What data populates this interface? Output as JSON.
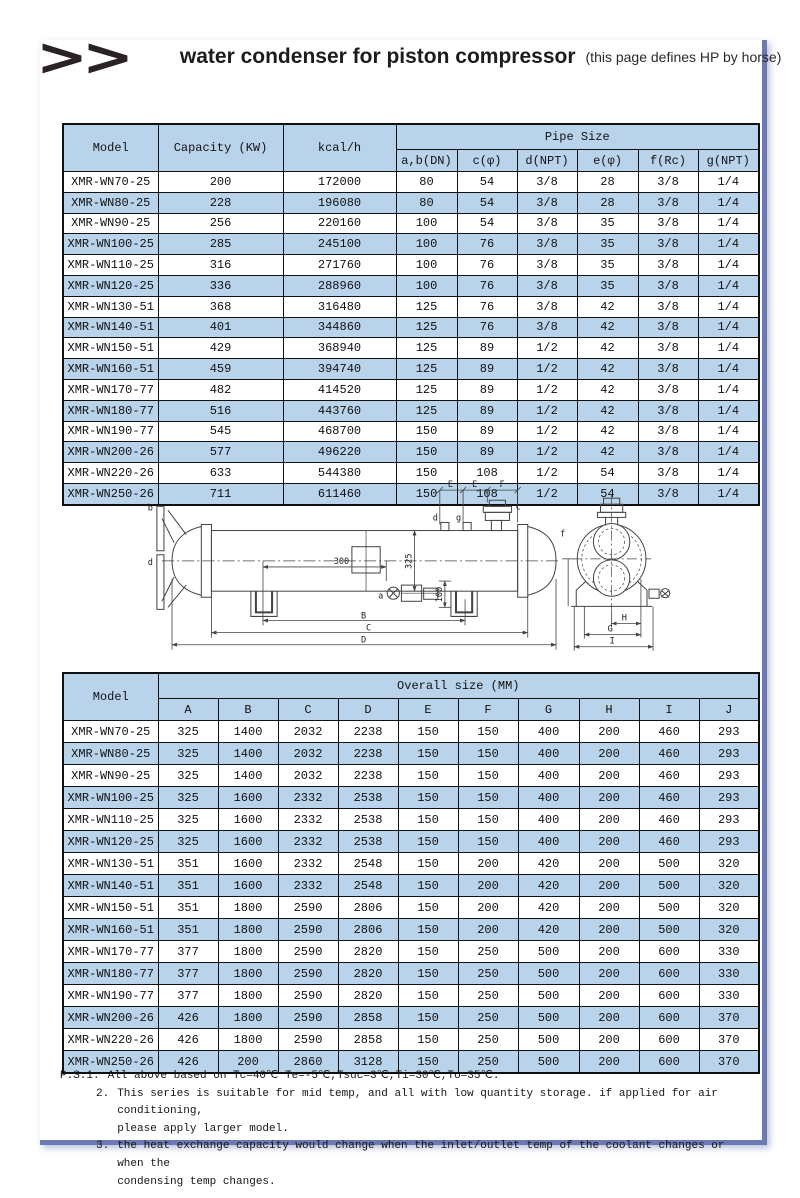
{
  "page": {
    "logo": ">>",
    "title": "water condenser for piston compressor",
    "subtitle": "(this page defines HP by horse)"
  },
  "colors": {
    "row_alt": "#b9d3ea",
    "header_bg": "#b9d3ea",
    "frame_rule": "#6b79b5",
    "table_border": "#101010"
  },
  "pipe_table": {
    "col_model": "Model",
    "col_capacity": "Capacity (KW)",
    "col_kcal": "kcal/h",
    "group_header": "Pipe Size",
    "sub_headers": [
      "a,b(DN)",
      "c(φ)",
      "d(NPT)",
      "e(φ)",
      "f(Rc)",
      "g(NPT)"
    ],
    "rows": [
      [
        "XMR-WN70-25",
        "200",
        "172000",
        "80",
        "54",
        "3/8",
        "28",
        "3/8",
        "1/4"
      ],
      [
        "XMR-WN80-25",
        "228",
        "196080",
        "80",
        "54",
        "3/8",
        "28",
        "3/8",
        "1/4"
      ],
      [
        "XMR-WN90-25",
        "256",
        "220160",
        "100",
        "54",
        "3/8",
        "35",
        "3/8",
        "1/4"
      ],
      [
        "XMR-WN100-25",
        "285",
        "245100",
        "100",
        "76",
        "3/8",
        "35",
        "3/8",
        "1/4"
      ],
      [
        "XMR-WN110-25",
        "316",
        "271760",
        "100",
        "76",
        "3/8",
        "35",
        "3/8",
        "1/4"
      ],
      [
        "XMR-WN120-25",
        "336",
        "288960",
        "100",
        "76",
        "3/8",
        "35",
        "3/8",
        "1/4"
      ],
      [
        "XMR-WN130-51",
        "368",
        "316480",
        "125",
        "76",
        "3/8",
        "42",
        "3/8",
        "1/4"
      ],
      [
        "XMR-WN140-51",
        "401",
        "344860",
        "125",
        "76",
        "3/8",
        "42",
        "3/8",
        "1/4"
      ],
      [
        "XMR-WN150-51",
        "429",
        "368940",
        "125",
        "89",
        "1/2",
        "42",
        "3/8",
        "1/4"
      ],
      [
        "XMR-WN160-51",
        "459",
        "394740",
        "125",
        "89",
        "1/2",
        "42",
        "3/8",
        "1/4"
      ],
      [
        "XMR-WN170-77",
        "482",
        "414520",
        "125",
        "89",
        "1/2",
        "42",
        "3/8",
        "1/4"
      ],
      [
        "XMR-WN180-77",
        "516",
        "443760",
        "125",
        "89",
        "1/2",
        "42",
        "3/8",
        "1/4"
      ],
      [
        "XMR-WN190-77",
        "545",
        "468700",
        "150",
        "89",
        "1/2",
        "42",
        "3/8",
        "1/4"
      ],
      [
        "XMR-WN200-26",
        "577",
        "496220",
        "150",
        "89",
        "1/2",
        "42",
        "3/8",
        "1/4"
      ],
      [
        "XMR-WN220-26",
        "633",
        "544380",
        "150",
        "108",
        "1/2",
        "54",
        "3/8",
        "1/4"
      ],
      [
        "XMR-WN250-26",
        "711",
        "611460",
        "150",
        "108",
        "1/2",
        "54",
        "3/8",
        "1/4"
      ]
    ]
  },
  "diagram": {
    "dim_e1": "E",
    "dim_e2": "E",
    "dim_f_top": "F",
    "label_b": "b",
    "label_d_left": "d",
    "label_a": "a",
    "label_d_top": "d",
    "label_g": "g",
    "label_c": "c",
    "label_f": "f",
    "dim_300": "300",
    "dim_325": "325",
    "dim_100": "100",
    "dim_B": "B",
    "dim_C": "C",
    "dim_D": "D",
    "dim_H": "H",
    "dim_G": "G",
    "dim_I": "I"
  },
  "size_table": {
    "col_model": "Model",
    "group_header": "Overall size (MM)",
    "sub_headers": [
      "A",
      "B",
      "C",
      "D",
      "E",
      "F",
      "G",
      "H",
      "I",
      "J"
    ],
    "rows": [
      [
        "XMR-WN70-25",
        "325",
        "1400",
        "2032",
        "2238",
        "150",
        "150",
        "400",
        "200",
        "460",
        "293"
      ],
      [
        "XMR-WN80-25",
        "325",
        "1400",
        "2032",
        "2238",
        "150",
        "150",
        "400",
        "200",
        "460",
        "293"
      ],
      [
        "XMR-WN90-25",
        "325",
        "1400",
        "2032",
        "2238",
        "150",
        "150",
        "400",
        "200",
        "460",
        "293"
      ],
      [
        "XMR-WN100-25",
        "325",
        "1600",
        "2332",
        "2538",
        "150",
        "150",
        "400",
        "200",
        "460",
        "293"
      ],
      [
        "XMR-WN110-25",
        "325",
        "1600",
        "2332",
        "2538",
        "150",
        "150",
        "400",
        "200",
        "460",
        "293"
      ],
      [
        "XMR-WN120-25",
        "325",
        "1600",
        "2332",
        "2538",
        "150",
        "150",
        "400",
        "200",
        "460",
        "293"
      ],
      [
        "XMR-WN130-51",
        "351",
        "1600",
        "2332",
        "2548",
        "150",
        "200",
        "420",
        "200",
        "500",
        "320"
      ],
      [
        "XMR-WN140-51",
        "351",
        "1600",
        "2332",
        "2548",
        "150",
        "200",
        "420",
        "200",
        "500",
        "320"
      ],
      [
        "XMR-WN150-51",
        "351",
        "1800",
        "2590",
        "2806",
        "150",
        "200",
        "420",
        "200",
        "500",
        "320"
      ],
      [
        "XMR-WN160-51",
        "351",
        "1800",
        "2590",
        "2806",
        "150",
        "200",
        "420",
        "200",
        "500",
        "320"
      ],
      [
        "XMR-WN170-77",
        "377",
        "1800",
        "2590",
        "2820",
        "150",
        "250",
        "500",
        "200",
        "600",
        "330"
      ],
      [
        "XMR-WN180-77",
        "377",
        "1800",
        "2590",
        "2820",
        "150",
        "250",
        "500",
        "200",
        "600",
        "330"
      ],
      [
        "XMR-WN190-77",
        "377",
        "1800",
        "2590",
        "2820",
        "150",
        "250",
        "500",
        "200",
        "600",
        "330"
      ],
      [
        "XMR-WN200-26",
        "426",
        "1800",
        "2590",
        "2858",
        "150",
        "250",
        "500",
        "200",
        "600",
        "370"
      ],
      [
        "XMR-WN220-26",
        "426",
        "1800",
        "2590",
        "2858",
        "150",
        "250",
        "500",
        "200",
        "600",
        "370"
      ],
      [
        "XMR-WN250-26",
        "426",
        "200",
        "2860",
        "3128",
        "150",
        "250",
        "500",
        "200",
        "600",
        "370"
      ]
    ]
  },
  "notes": {
    "items": [
      {
        "num": "P.S:1.",
        "lines": [
          "All above based on Tc=40℃ Te=-5℃,Tsuc=3℃,Ti=30℃,To=35℃."
        ]
      },
      {
        "num": "2.",
        "lines": [
          "This series is suitable for mid temp, and all with low quantity storage. if applied for air conditioning,",
          "please apply larger model."
        ]
      },
      {
        "num": "3.",
        "lines": [
          "the heat exchange capacity would change when the inlet/outlet temp of the coolant changes or when the",
          "condensing temp changes."
        ]
      }
    ]
  }
}
